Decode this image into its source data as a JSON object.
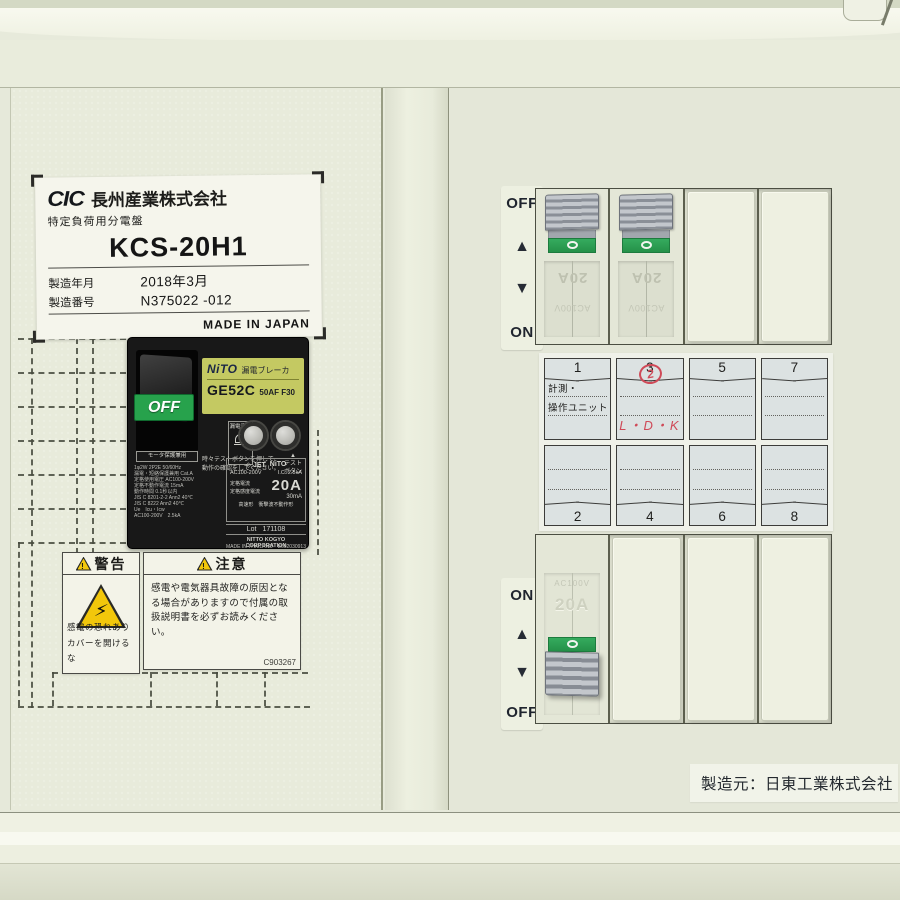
{
  "nameplate": {
    "brand": "CIC",
    "company": "長州産業株式会社",
    "product_type": "特定負荷用分電盤",
    "model": "KCS-20H1",
    "mfg_date_label": "製造年月",
    "mfg_date_value": "2018年3月",
    "serial_label": "製造番号",
    "serial_value": "N375022 -012",
    "origin": "MADE IN JAPAN"
  },
  "main_breaker": {
    "state": "OFF",
    "brand": "NiTO",
    "category": "漏電ブレーカ",
    "model": "GE52C",
    "frame": "50AF F30",
    "leak_indicator": "漏電表示",
    "test_note": "時々テストボタンを押して、\n動作の確認をしてください。",
    "test_pointer": "▲",
    "test_button_label": "テスト\nボタン",
    "spec_header": "モータ保護兼用",
    "spec_lines": [
      "1φ2W 2P2E 50/60Hz",
      "漏電・短絡保護兼用 Cat.A",
      "定格使用電圧 AC100-200V",
      "定格不動作電流 15mA",
      "動作時間 0.1秒以内",
      "JIS C 8201-2-2 Ann2 40℃",
      "JIS C 8222 Ann2 40℃",
      "Ue　Icu・Icw",
      "AC100-200V　2.5kA"
    ],
    "cert_mark": "◇ JET",
    "cert_brand": "NiTO",
    "rated_voltage": "AC100-200V",
    "breaking_capacity": "I.C. 2.5kA",
    "rated_current_label": "定格電流",
    "sensitivity_label": "定格感度電流",
    "rated_current": "20A",
    "sensitivity": "30mA",
    "type_note": "高速形　衝撃波不動作形",
    "lot_label": "Lot",
    "lot": "171108",
    "maker": "NITTO KOGYO CORPORATION",
    "origin": "MADE IN THAILAND",
    "code": "B602030913"
  },
  "warning_label": {
    "title": "警告",
    "body": "感電の恐れあり\nカバーを開けるな"
  },
  "caution_label": {
    "title": "注意",
    "body": "感電や電気器具故障の原因となる場合がありますので付属の取扱説明書を必ずお読みください。",
    "code": "C903267"
  },
  "right_panel": {
    "top_indicator": {
      "top": "OFF",
      "up": "▲",
      "down": "▼",
      "bottom": "ON"
    },
    "bottom_indicator": {
      "top": "ON",
      "up": "▲",
      "down": "▼",
      "bottom": "OFF"
    },
    "branch_breaker": {
      "rating": "20A",
      "voltage": "AC100V"
    },
    "circuit_grid": {
      "top_cells": [
        {
          "num": "1",
          "label": "計測・\n操作ユニット"
        },
        {
          "num": "3",
          "mark": "2",
          "note": "L・D・K"
        },
        {
          "num": "5"
        },
        {
          "num": "7"
        }
      ],
      "bottom_cells": [
        {
          "num": "2"
        },
        {
          "num": "4"
        },
        {
          "num": "6"
        },
        {
          "num": "8"
        }
      ]
    },
    "manufacturer": "製造元：日東工業株式会社"
  },
  "icons": {
    "warning_mark": "!",
    "lightning": "⚡"
  },
  "colors": {
    "panel": "#e7eadb",
    "accent_green": "#2da156",
    "nito_label_yellow": "#c4c962",
    "warning_yellow": "#f2c70b",
    "handwriting_red": "#cf4a58"
  }
}
